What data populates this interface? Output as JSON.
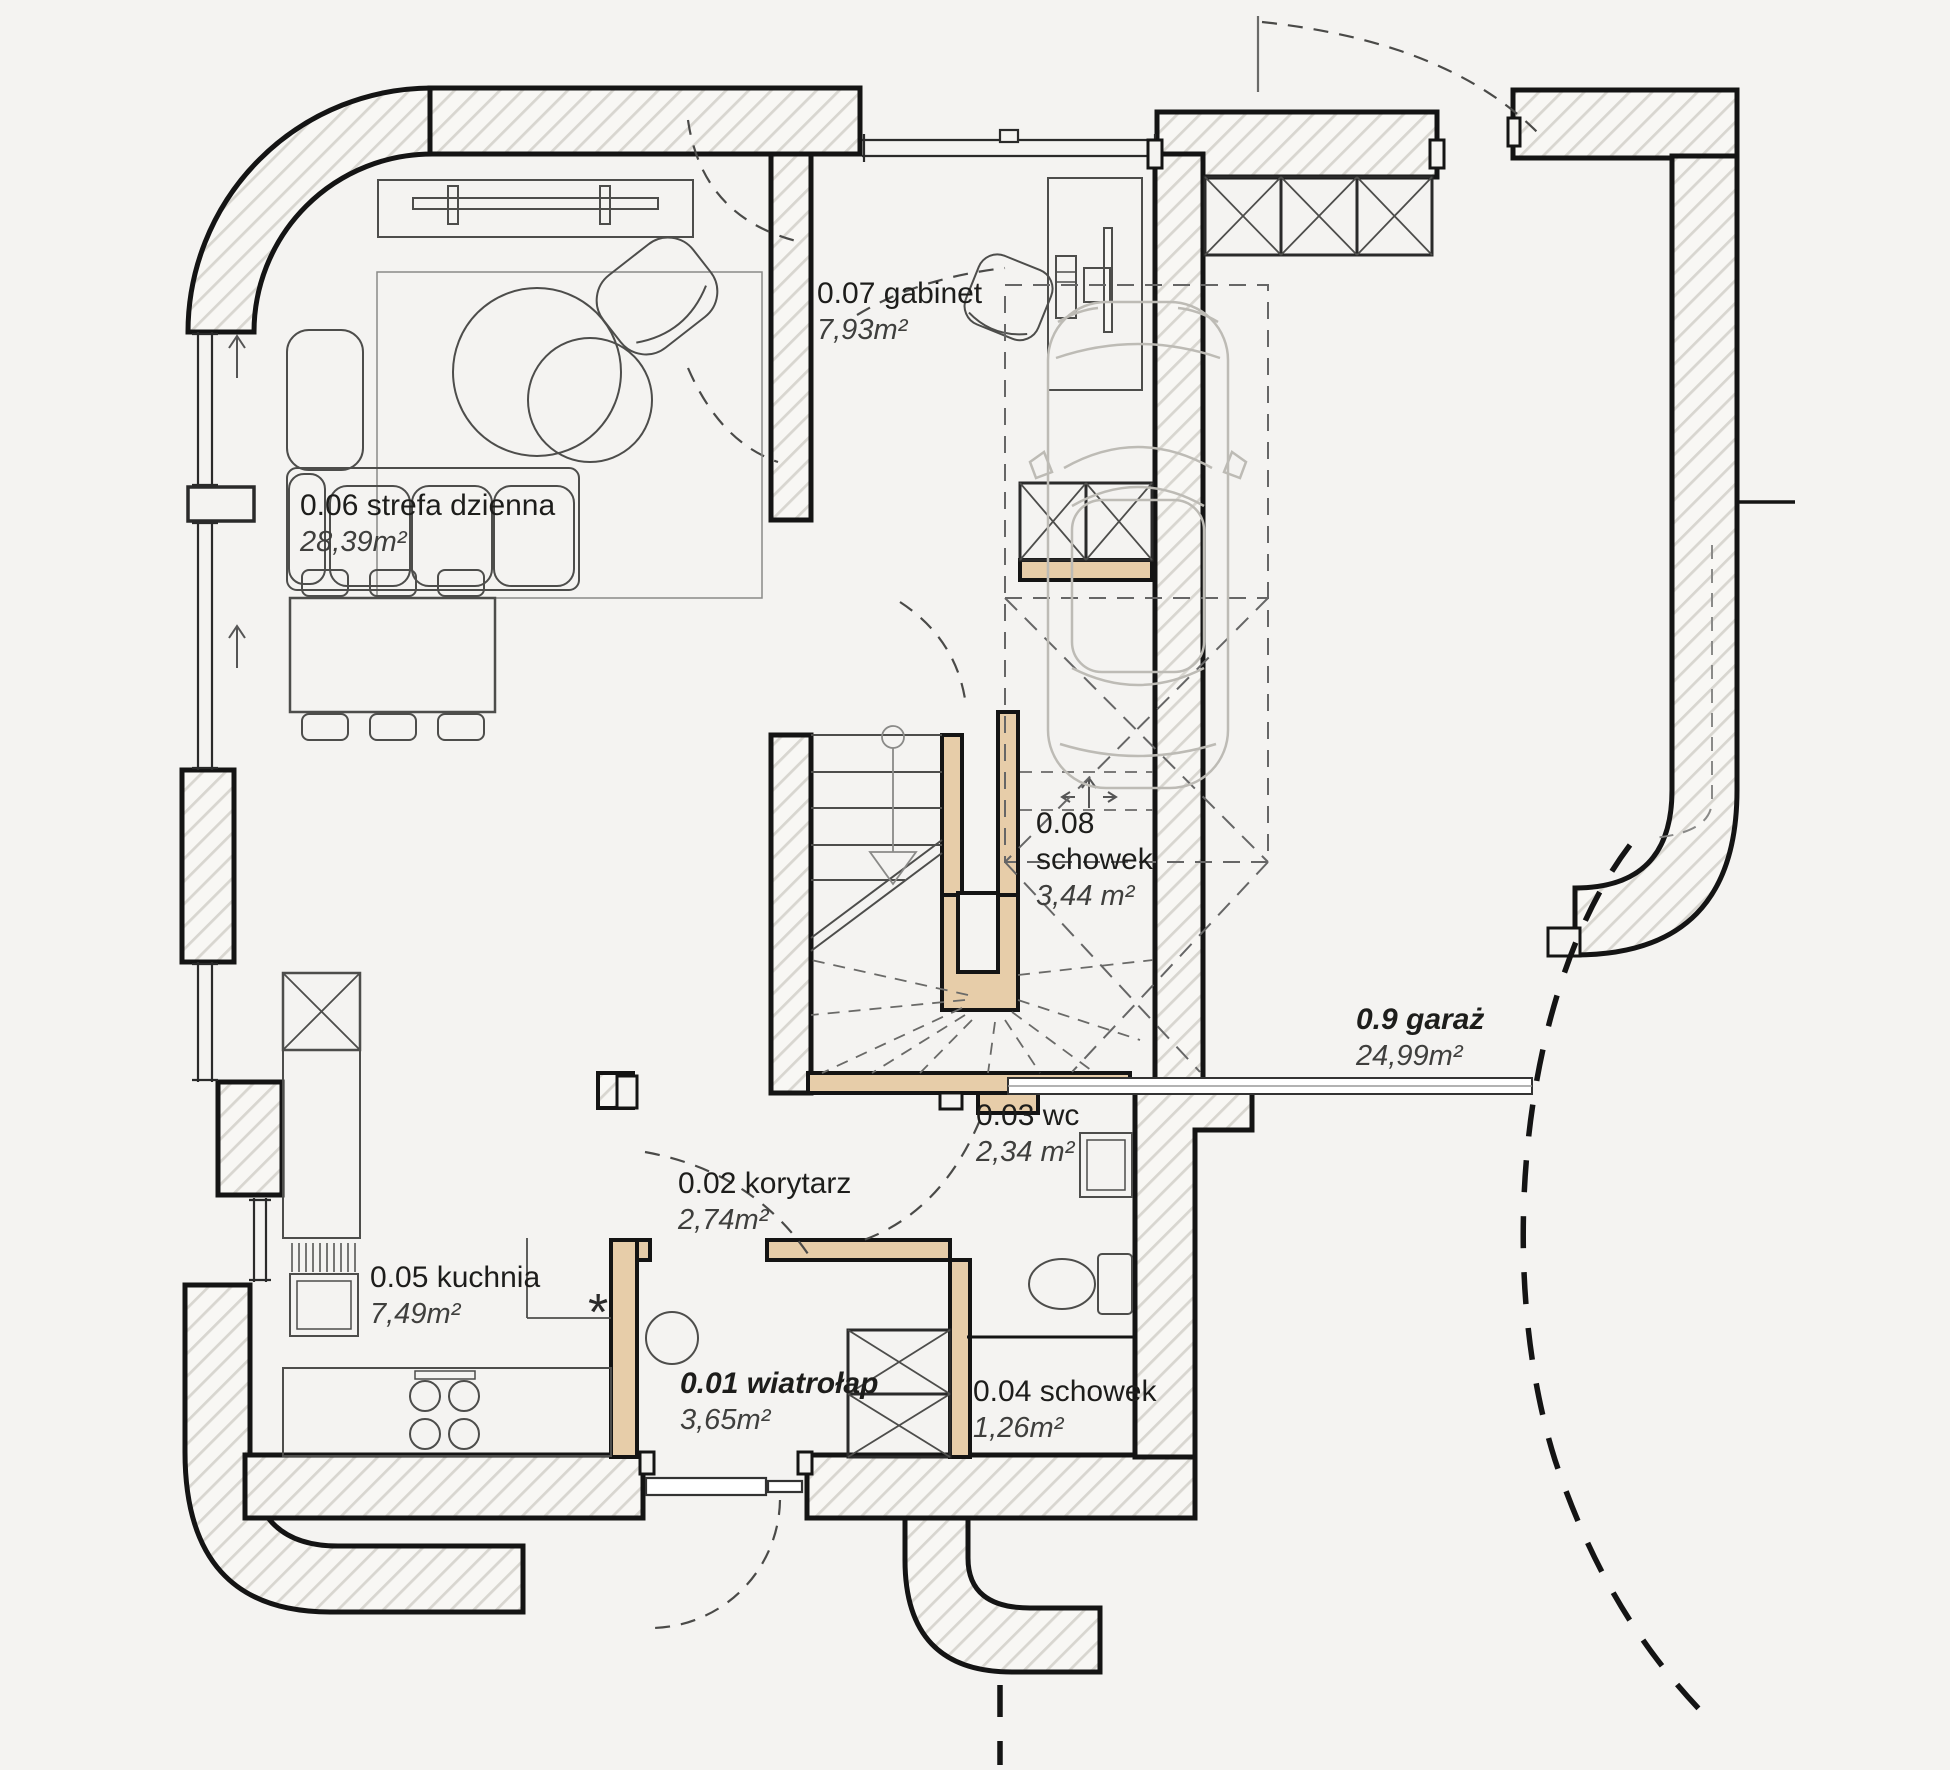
{
  "plan": {
    "background": "#f4f3f1",
    "wall_fill": "#f8f7f4",
    "wall_hatch_color": "#d8d6d0",
    "wall_stroke": "#141414",
    "wood_wall_color": "#e7cda9",
    "furniture_line": "#4d4d4b",
    "car_line": "#bdbbb5"
  },
  "rooms": [
    {
      "id": "0.01",
      "name": "0.01 wiatrołap",
      "area": "3,65m²"
    },
    {
      "id": "0.02",
      "name": "0.02 korytarz",
      "area": "2,74m²"
    },
    {
      "id": "0.03",
      "name": "0.03 wc",
      "area": "2,34 m²"
    },
    {
      "id": "0.04",
      "name": "0.04 schowek",
      "area": "1,26m²"
    },
    {
      "id": "0.05",
      "name": "0.05 kuchnia",
      "area": "7,49m²"
    },
    {
      "id": "0.06",
      "name": "0.06 strefa dzienna",
      "area": "28,39m²"
    },
    {
      "id": "0.07",
      "name": "0.07 gabinet",
      "area": "7,93m²"
    },
    {
      "id": "0.08",
      "name": "0.08 schowek",
      "area": "3,44 m²"
    },
    {
      "id": "0.9",
      "name": "0.9 garaż",
      "area": "24,99m²"
    }
  ],
  "symbols": {
    "kitchen_marker": "*"
  }
}
